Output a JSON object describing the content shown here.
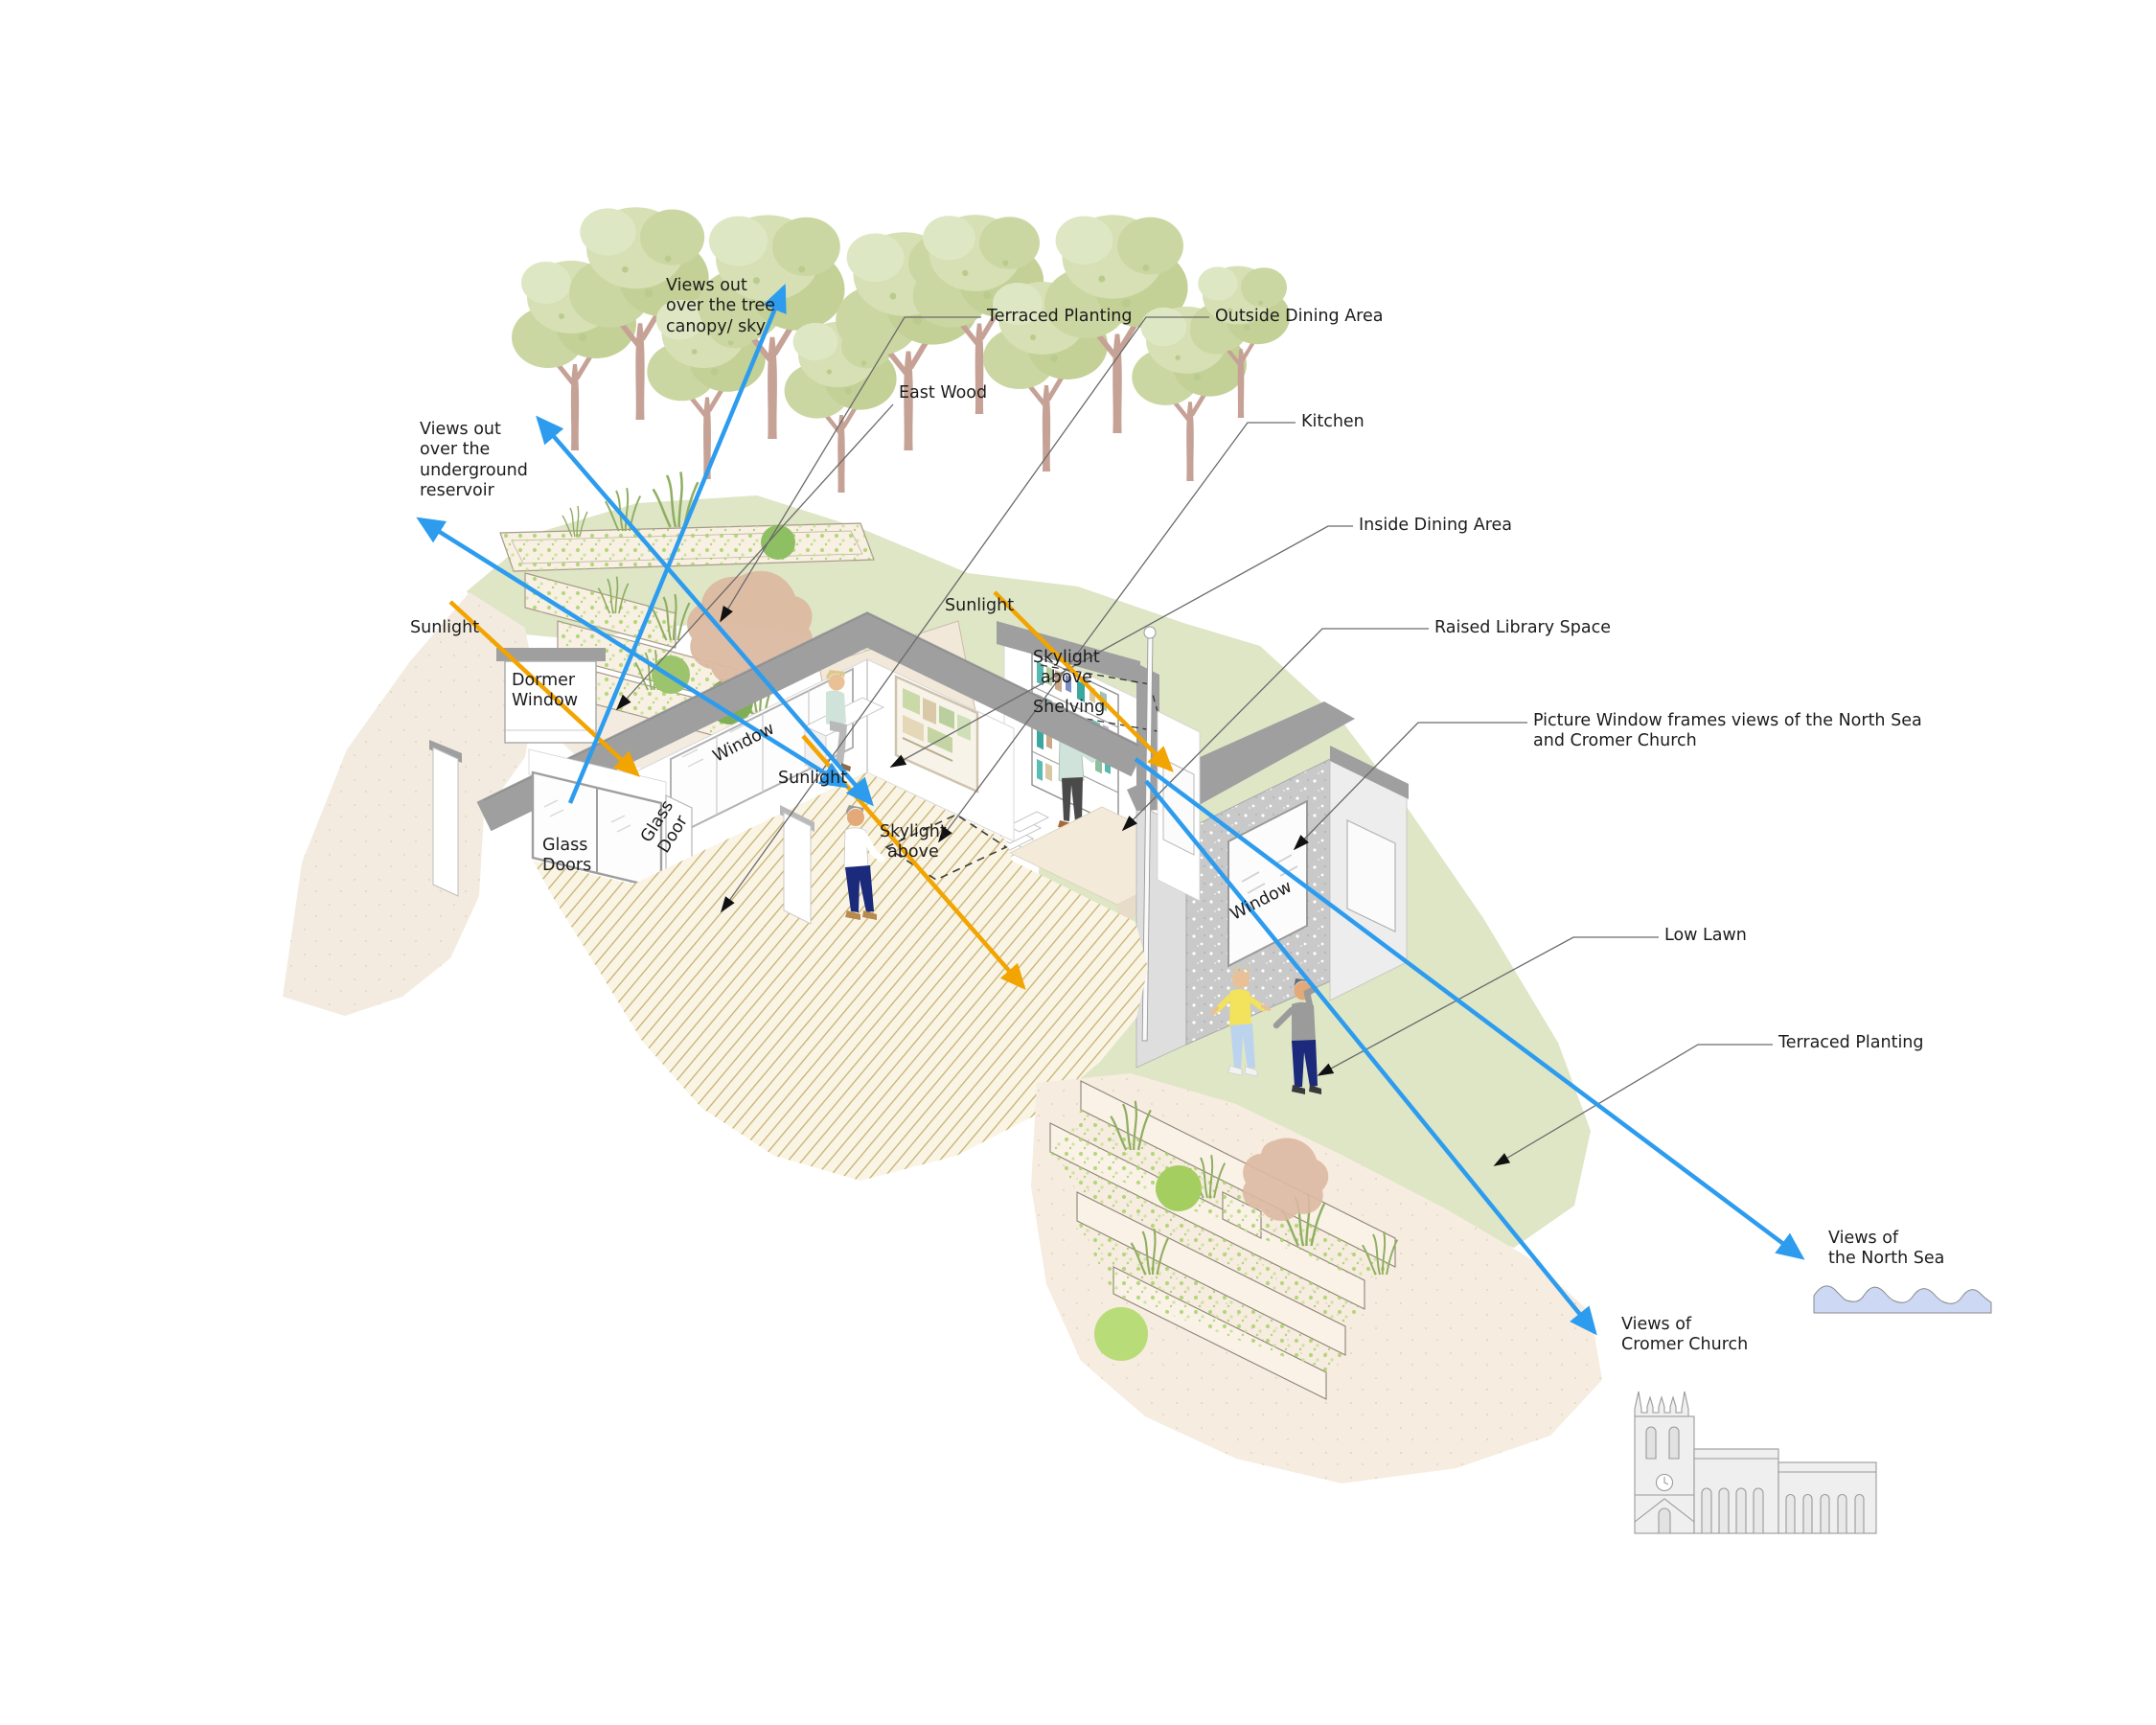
{
  "diagram": {
    "type": "architectural-section-axonometric-annotation",
    "annotations": {
      "views_tree_canopy": {
        "line1": "Views out",
        "line2": "over the tree",
        "line3": "canopy/ sky"
      },
      "views_reservoir": {
        "line1": "Views out",
        "line2": "over the",
        "line3": "underground",
        "line4": "reservoir"
      },
      "terraced_planting_top": "Terraced Planting",
      "outside_dining": "Outside Dining Area",
      "east_wood": "East Wood",
      "kitchen": "Kitchen",
      "inside_dining": "Inside Dining Area",
      "raised_library": "Raised Library Space",
      "picture_window": {
        "line1": "Picture Window frames views of the North Sea",
        "line2": "and Cromer Church"
      },
      "low_lawn": "Low Lawn",
      "terraced_planting_right": "Terraced Planting",
      "views_north_sea": {
        "line1": "Views of",
        "line2": "the North Sea"
      },
      "views_cromer": {
        "line1": "Views of",
        "line2": "Cromer Church"
      },
      "sunlight_left": "Sunlight",
      "sunlight_center": "Sunlight",
      "sunlight_interior": "Sunlight",
      "dormer_window": {
        "line1": "Dormer",
        "line2": "Window"
      },
      "glass_doors": {
        "line1": "Glass",
        "line2": "Doors"
      },
      "glass_door": {
        "line1": "Glass",
        "line2": "Door"
      },
      "window_main": "Window",
      "window_picture": "Window",
      "skylight_shelf": {
        "line1": "Skylight",
        "line2": "above"
      },
      "skylight_floor": {
        "line1": "Skylight",
        "line2": "above"
      },
      "shelving": "Shelving"
    },
    "colors": {
      "view_arrow_blue": "#2d9cee",
      "sunlight_arrow_orange": "#f2a400",
      "leader_line_gray": "#6a6a6a",
      "hill_green": "#dee6c6",
      "tree_canopy_green": "#cbd7a2",
      "tree_trunk_pink": "#c6a296",
      "soil_beige": "#f3ebdf",
      "roof_gray": "#9f9f9f",
      "concrete_gray": "#c9c9c9",
      "floor_hatch_olive": "#c6b172",
      "sea_blue": "#ccd8f4",
      "shrub_brown": "#dcb9a2"
    }
  }
}
